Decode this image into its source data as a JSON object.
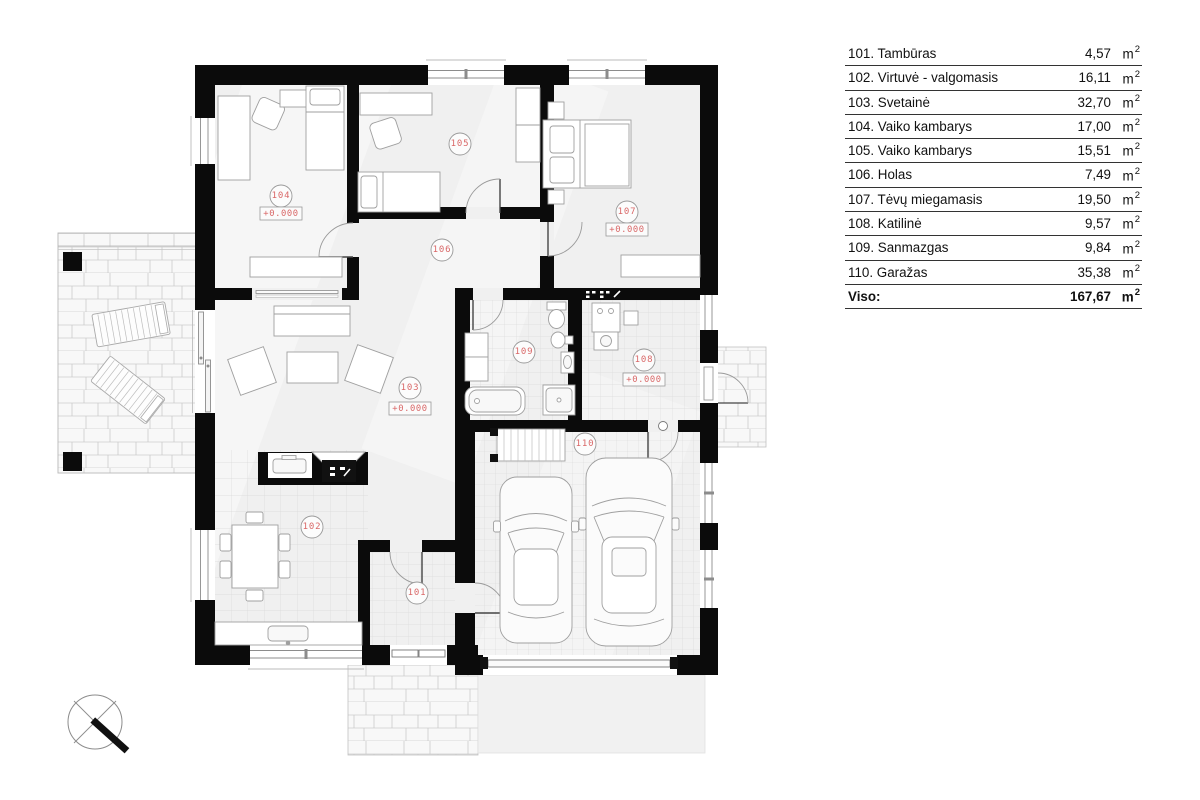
{
  "legend": {
    "rows": [
      {
        "label": "101. Tambūras",
        "number": "101",
        "area": "4,57"
      },
      {
        "label": "102. Virtuvė - valgomasis",
        "number": "102",
        "area": "16,11"
      },
      {
        "label": "103. Svetainė",
        "number": "103",
        "area": "32,70"
      },
      {
        "label": "104. Vaiko kambarys",
        "number": "104",
        "area": "17,00"
      },
      {
        "label": "105. Vaiko kambarys",
        "number": "105",
        "area": "15,51"
      },
      {
        "label": "106. Holas",
        "number": "106",
        "area": "7,49"
      },
      {
        "label": "107. Tėvų miegamasis",
        "number": "107",
        "area": "19,50"
      },
      {
        "label": "108. Katilinė",
        "number": "108",
        "area": "9,57"
      },
      {
        "label": "109. Sanmazgas",
        "number": "109",
        "area": "9,84"
      },
      {
        "label": "110. Garažas",
        "number": "110",
        "area": "35,38"
      }
    ],
    "total_label": "Viso:",
    "total_area": "167,67",
    "unit_base": "m",
    "unit_exp": "2"
  },
  "plan": {
    "level": "+0.000",
    "accent_red": "#d96868",
    "wall_color": "#0b0b0b"
  }
}
